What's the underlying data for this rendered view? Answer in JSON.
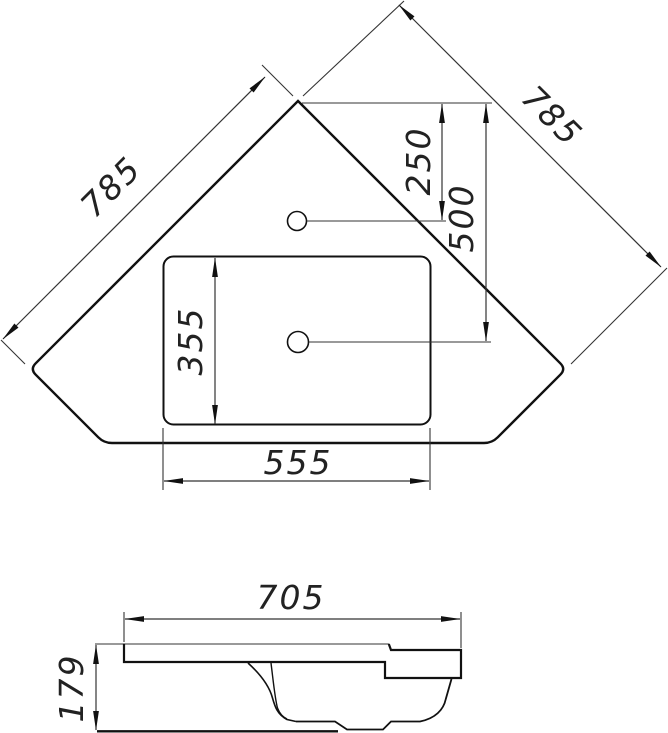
{
  "drawing": {
    "type": "technical-drawing",
    "subject": "corner washbasin, plan view and side section view",
    "colors": {
      "background": "#ffffff",
      "outline": "#111111",
      "dimension_lines": "#333333",
      "dimension_text": "#222222"
    },
    "plan_view": {
      "dim_edge_left": "785",
      "dim_edge_right": "785",
      "dim_faucet_offset": "250",
      "dim_drain_offset": "500",
      "dim_basin_depth": "355",
      "dim_basin_width": "555"
    },
    "side_view": {
      "dim_overall_width": "705",
      "dim_overall_height": "179"
    }
  }
}
